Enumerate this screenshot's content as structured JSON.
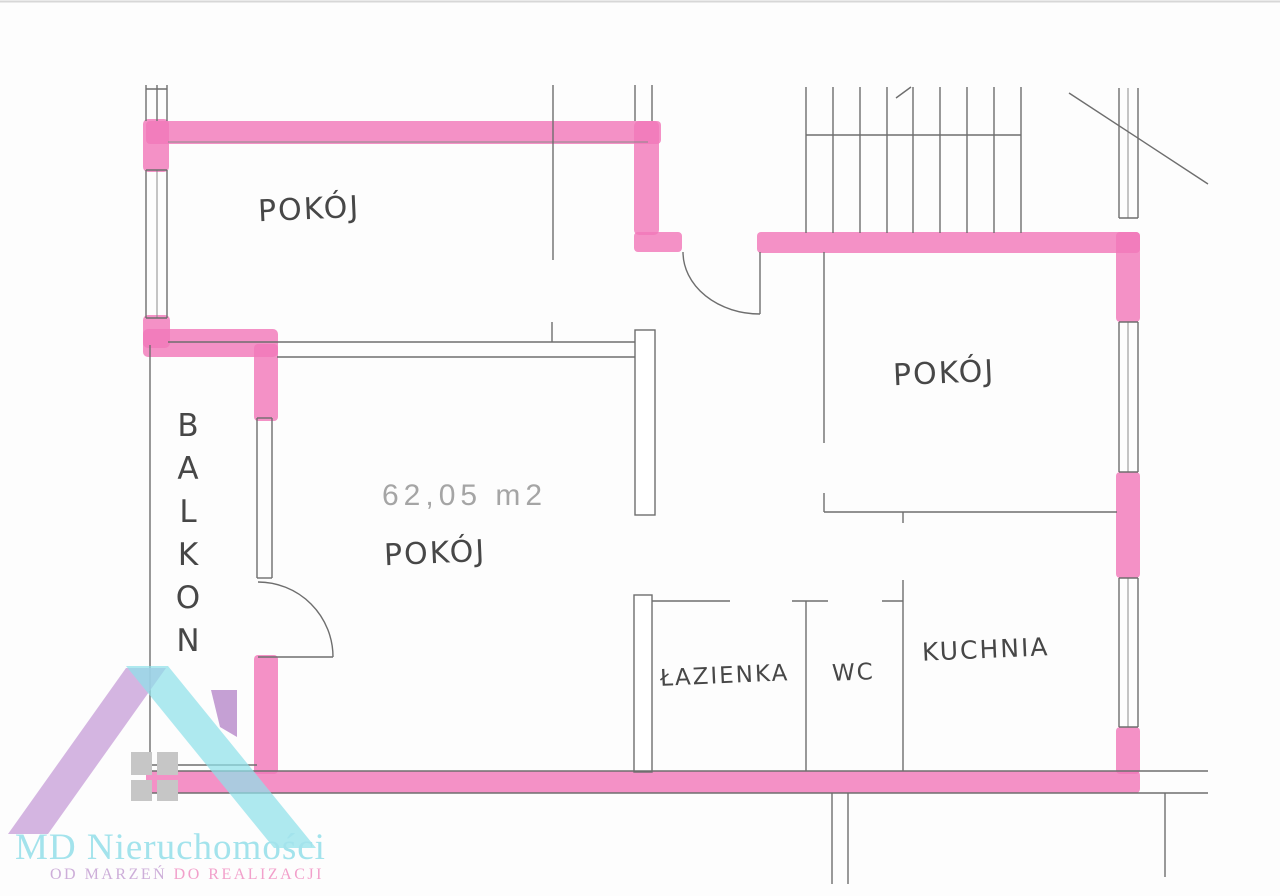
{
  "plan": {
    "area_label": "62,05 m2",
    "rooms": [
      {
        "id": "room-top-left",
        "label": "POKÓJ"
      },
      {
        "id": "room-right",
        "label": "POKÓJ"
      },
      {
        "id": "room-living",
        "label": "POKÓJ"
      },
      {
        "id": "balcony",
        "label": "BALKON"
      },
      {
        "id": "bathroom",
        "label": "ŁAZIENKA"
      },
      {
        "id": "wc",
        "label": "WC"
      },
      {
        "id": "kitchen",
        "label": "KUCHNIA"
      }
    ]
  },
  "logo": {
    "company": "MD Nieruchomości",
    "tagline_left": "OD MARZEŃ",
    "tagline_right": "DO REALIZACJI"
  },
  "colors": {
    "highlight_pink": "#f279ba",
    "wall_line": "#6e6e6e",
    "logo_cyan": "#8fe0e9",
    "logo_lavender": "#c9a3da",
    "logo_purple": "#bb8fcc",
    "logo_text_cyan": "#a3e3ec",
    "logo_tagline_lavender": "#cdaed9",
    "logo_tagline_pink": "#f2a0cb"
  }
}
